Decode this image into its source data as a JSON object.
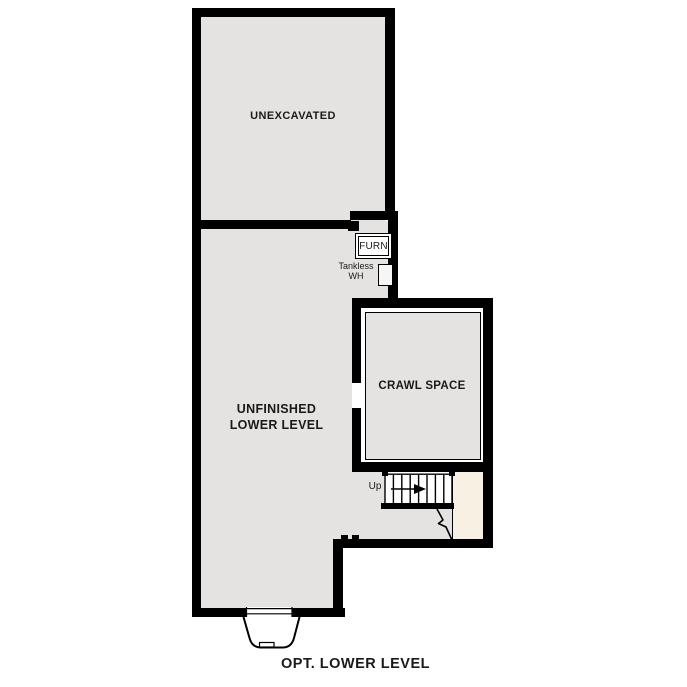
{
  "plan_title": "OPT. LOWER LEVEL",
  "rooms": {
    "unexcavated": {
      "label": "UNEXCAVATED"
    },
    "unfinished_lower_level": {
      "label": "UNFINISHED\nLOWER LEVEL"
    },
    "crawl_space": {
      "label": "CRAWL SPACE"
    }
  },
  "equipment": {
    "furnace": {
      "label": "FURN"
    },
    "tankless_water_heater": {
      "label": "Tankless\nWH"
    }
  },
  "stairs": {
    "direction_label": "Up"
  },
  "colors": {
    "wall": "#000000",
    "floor": "#e4e3e1",
    "landing": "#f8f1e3",
    "background": "#ffffff",
    "text": "#1a1a1a"
  }
}
